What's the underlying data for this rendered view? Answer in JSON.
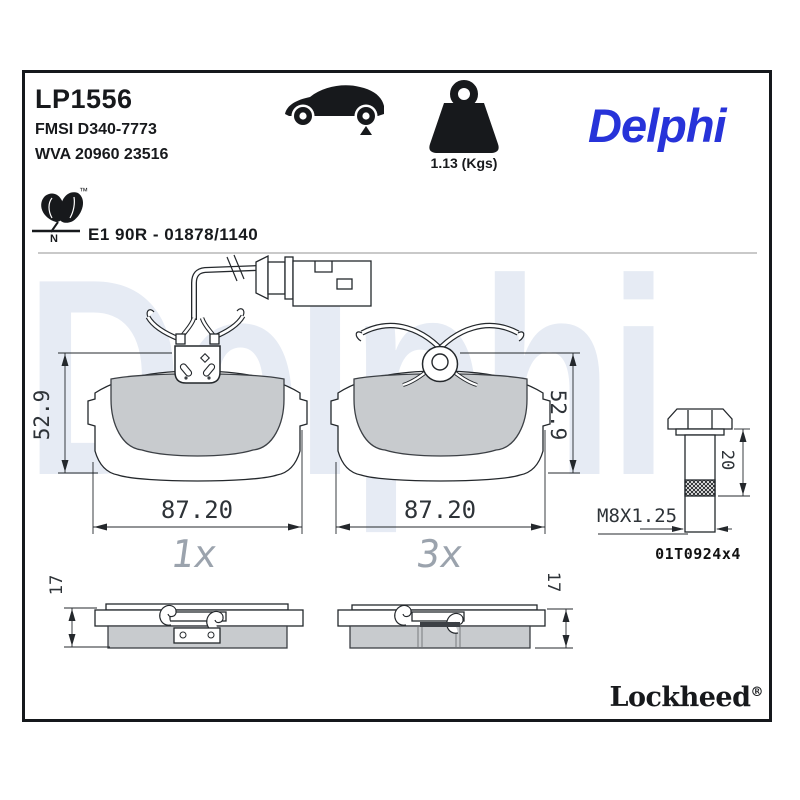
{
  "header": {
    "part_number": "LP1556",
    "fmsi": "FMSI D340-7773",
    "wva": "WVA 20960 23516",
    "weight": "1.13 (Kgs)",
    "brand": "Delphi"
  },
  "approval": {
    "text": "E1 90R - 01878/1140",
    "n_letter": "N",
    "tm": "™"
  },
  "watermark": "Delphi",
  "pads": {
    "sensor_pad": {
      "qty": "1x",
      "width": "87.20",
      "height": "52.9"
    },
    "clip_pad": {
      "qty": "3x",
      "width": "87.20",
      "height": "52.9"
    },
    "side_left": {
      "thickness": "17"
    },
    "side_right": {
      "thickness": "17"
    }
  },
  "bolt": {
    "length": "20",
    "thread": "M8X1.25",
    "ref": "01T0924x4"
  },
  "footer": {
    "brand": "Lockheed",
    "reg": "®"
  },
  "colors": {
    "brand_blue": "#2733d9",
    "watermark": "#e6ebf4",
    "friction_gray": "#c8cbce"
  }
}
